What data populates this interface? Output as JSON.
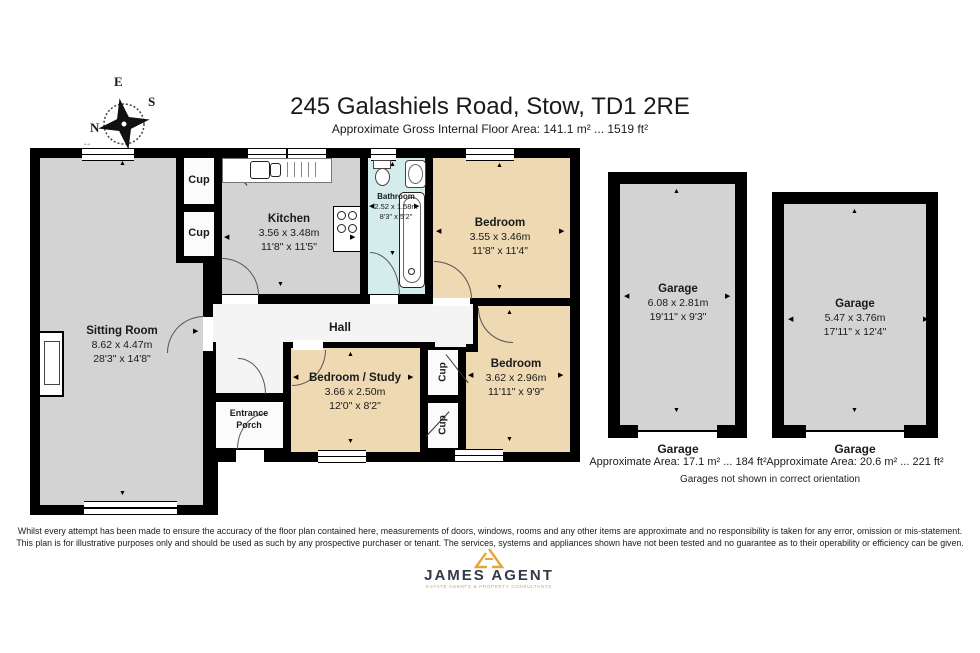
{
  "title": "245 Galashiels Road, Stow, TD1 2RE",
  "subtitle": "Approximate Gross Internal Floor Area: 141.1 m² ... 1519 ft²",
  "compass": {
    "n": "N",
    "e": "E",
    "s": "S",
    "w": "W"
  },
  "labels": {
    "cup": "Cup",
    "hall": "Hall",
    "porch_line1": "Entrance",
    "porch_line2": "Porch"
  },
  "rooms": {
    "sitting": {
      "name": "Sitting Room",
      "metric": "8.62 x 4.47m",
      "imperial": "28'3\" x 14'8\""
    },
    "kitchen": {
      "name": "Kitchen",
      "metric": "3.56 x 3.48m",
      "imperial": "11'8\" x 11'5\""
    },
    "bathroom": {
      "name": "Bathroom",
      "metric": "2.52 x 1.58m",
      "imperial": "8'3\" x 5'2\""
    },
    "bedroom_top": {
      "name": "Bedroom",
      "metric": "3.55 x 3.46m",
      "imperial": "11'8\" x 11'4\""
    },
    "bedroom_right": {
      "name": "Bedroom",
      "metric": "3.62 x 2.96m",
      "imperial": "11'11\" x 9'9\""
    },
    "bedroom_study": {
      "name": "Bedroom / Study",
      "metric": "3.66 x 2.50m",
      "imperial": "12'0\" x 8'2\""
    }
  },
  "garages": [
    {
      "plan_name": "Garage",
      "metric": "6.08 x 2.81m",
      "imperial": "19'11\" x 9'3\"",
      "caption_title": "Garage",
      "caption_area": "Approximate Area: 17.1 m² ... 184 ft²"
    },
    {
      "plan_name": "Garage",
      "metric": "5.47 x 3.76m",
      "imperial": "17'11\" x 12'4\"",
      "caption_title": "Garage",
      "caption_area": "Approximate Area: 20.6 m² ... 221 ft²"
    }
  ],
  "garage_note": "Garages not shown in correct orientation",
  "disclaimer_line1": "Whilst every attempt has been made to ensure the accuracy of the floor plan contained here, measurements of doors, windows, rooms and any other items are approximate and no responsibility is taken for any error, omission or mis-statement.",
  "disclaimer_line2": "This plan is for illustrative purposes only and should be used as such by any prospective purchaser or tenant. The services, systems and appliances shown have not been tested and no guarantee as to their operability or efficiency can be given.",
  "logo": {
    "name": "JAMES AGENT",
    "tagline": "ESTATE AGENTS & PROPERTY CONSULTANTS"
  },
  "colors": {
    "wall": "#000000",
    "room_grey": "#d3d3d3",
    "room_tan": "#eed9b2",
    "bathroom": "#d4ecec",
    "hall": "#f4f4f4",
    "accent_orange": "#e8a33d"
  }
}
